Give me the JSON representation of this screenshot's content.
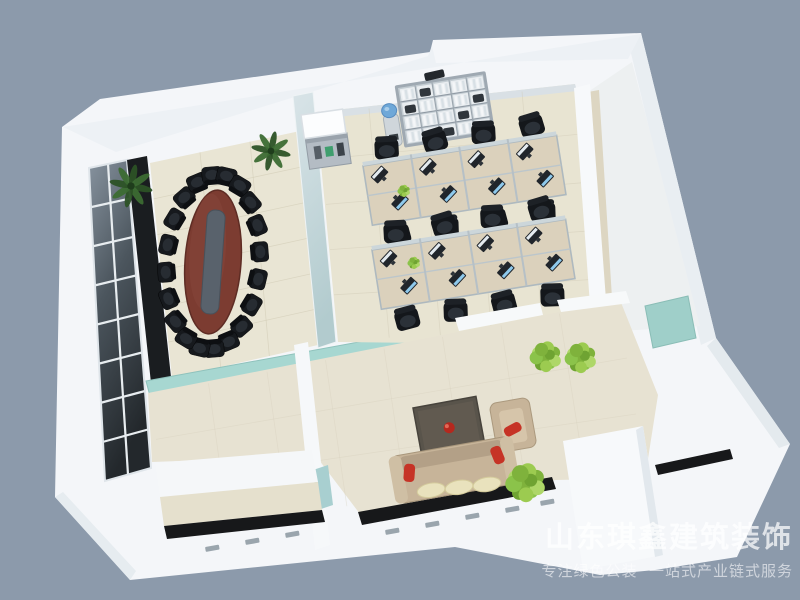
{
  "watermark": {
    "line1": "山东琪鑫建筑装饰",
    "line2": "专注绿色公装  一站式产业链式服务"
  },
  "scene": {
    "type": "3d-isometric-office-interior-floorplan-render",
    "background_color": "#8c9aab",
    "palette": {
      "walls": "#f4f6f9",
      "floor_cream": "#e9e5d4",
      "accent_teal": "#a7d7d1",
      "conference_table": "#7c3c31",
      "chair_black": "#16191d",
      "desk_wood": "#dbd1bc",
      "sofa_beige": "#c7b499",
      "pillow_red": "#c63326",
      "granite_sill": "#17181a",
      "plant_green": "#8bc34a",
      "glass_blue": "#6fa8d8"
    },
    "rooms": [
      {
        "id": "conference-room",
        "chair_count": 20,
        "features": [
          "glazed-window-wall",
          "oval-conference-table",
          "black-chairs",
          "potted-palms",
          "frosted-glass-partition",
          "teal-glass-lower-wall"
        ]
      },
      {
        "id": "open-office",
        "workstation_count": 16,
        "cubicle_banks": 2,
        "features": [
          "cubicle-desks",
          "black-task-chairs",
          "monitors",
          "bookshelf-with-binders",
          "water-dispenser",
          "presentation-cart",
          "desk-plants"
        ]
      },
      {
        "id": "lounge",
        "features": [
          "three-seat-sofa",
          "armchair",
          "red-accent-pillows",
          "pale-seat-cushions",
          "dark-coffee-table",
          "red-bowl",
          "green-shrubs"
        ]
      },
      {
        "id": "entry-vestibule",
        "features": [
          "teal-accent-panel",
          "white-partition-volume",
          "granite-floor-strip"
        ]
      },
      {
        "id": "side-room",
        "features": [
          "empty-white-room"
        ]
      },
      {
        "id": "lower-corridor",
        "features": [
          "granite-window-sills",
          "window-frames"
        ]
      }
    ]
  }
}
